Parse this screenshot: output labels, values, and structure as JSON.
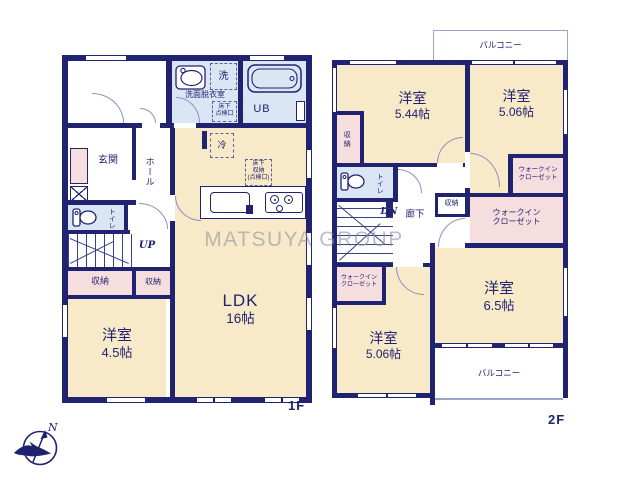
{
  "watermark": "MATSUYA GROUP",
  "compass": {
    "north_label": "N"
  },
  "floor1": {
    "floor_label": "1F",
    "washroom": {
      "label": "洗面脱衣室",
      "washer": "洗",
      "hatch": "床下\n点検口"
    },
    "bath": {
      "label": "UB"
    },
    "entrance": {
      "label": "玄関"
    },
    "hall": {
      "label": "ホール"
    },
    "toilet": {
      "label": "トイレ"
    },
    "stairs": {
      "label": "UP"
    },
    "storage_a": {
      "label": "収納"
    },
    "storage_b": {
      "label": "収納"
    },
    "fridge": {
      "label": "冷"
    },
    "underfloor_storage": {
      "label": "床下\n収納\n(点検口)"
    },
    "ldk": {
      "name": "LDK",
      "size": "16帖"
    },
    "bedroom": {
      "name": "洋室",
      "size": "4.5帖"
    }
  },
  "floor2": {
    "floor_label": "2F",
    "balcony_top": {
      "label": "バルコニー"
    },
    "balcony_bottom": {
      "label": "バルコニー"
    },
    "bedroom_a": {
      "name": "洋室",
      "size": "5.44帖"
    },
    "bedroom_b": {
      "name": "洋室",
      "size": "5.06帖"
    },
    "bedroom_c": {
      "name": "洋室",
      "size": "6.5帖"
    },
    "bedroom_d": {
      "name": "洋室",
      "size": "5.06帖"
    },
    "storage_a": {
      "label": "収納"
    },
    "storage_b": {
      "label": "収納"
    },
    "toilet": {
      "label": "トイレ"
    },
    "stairs": {
      "label": "DN"
    },
    "corridor": {
      "label": "廊下"
    },
    "wic_a": {
      "label": "ウォークイン\nクローゼット"
    },
    "wic_b": {
      "label": "ウォークイン\nクローゼット"
    },
    "wic_c": {
      "label": "ウォークイン\nクローゼット"
    }
  }
}
